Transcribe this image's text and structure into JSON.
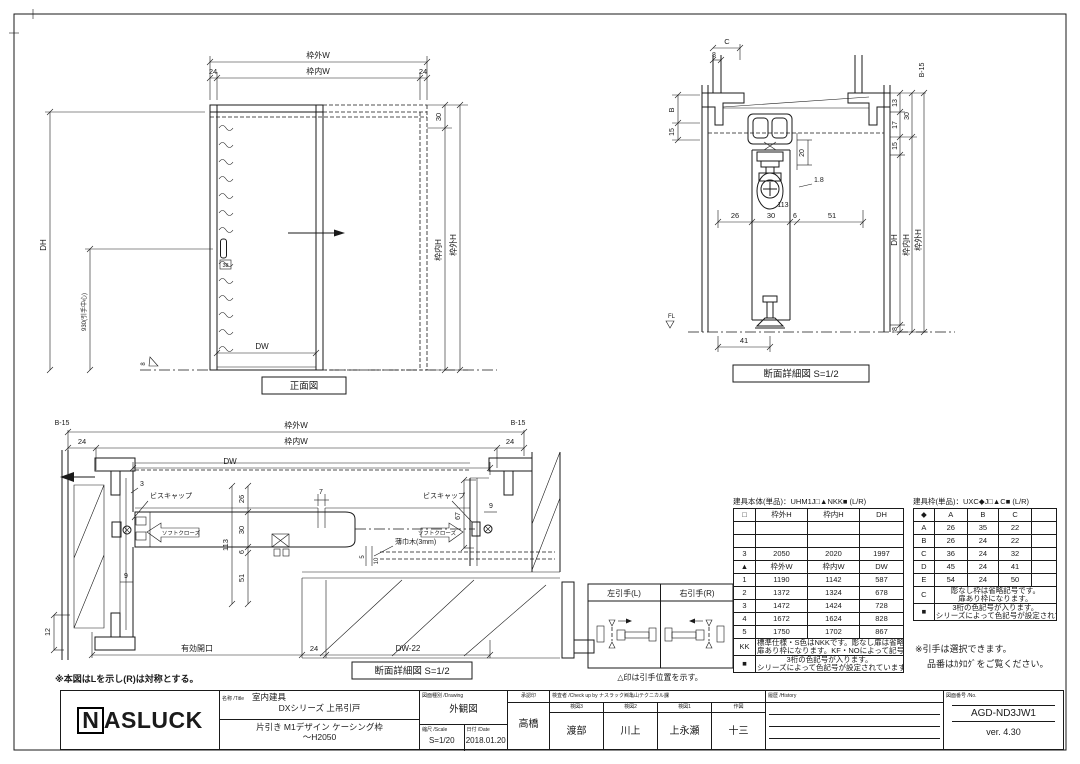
{
  "colors": {
    "paper": "#ffffff",
    "ink": "#1a1a1a"
  },
  "fv": {
    "title": "正面図",
    "wgw": "枠外W",
    "wnw": "枠内W",
    "d24l": "24",
    "d24r": "24",
    "d30": "30",
    "wnh": "枠内H",
    "wgh": "枠外H",
    "dh": "DH",
    "d930": "930(引手中心)",
    "d38": "38",
    "dw": "DW",
    "d8": "8"
  },
  "st": {
    "title": "断面詳細図 S=1/2",
    "c": "C",
    "d8t": "8",
    "b": "B",
    "d15l": "15",
    "d20": "20",
    "d18": "1.8",
    "d113": "113",
    "d26": "26",
    "d30": "30",
    "d6": "6",
    "d51": "51",
    "b15": "B-15",
    "d13": "13",
    "d17": "17",
    "d30r": "30",
    "d15r": "15",
    "dh": "DH",
    "wnh": "枠内H",
    "wgh": "枠外H",
    "d8b": "8",
    "d41": "41",
    "fl": "FL"
  },
  "sp": {
    "title": "断面詳細図 S=1/2",
    "note": "※本図はLを示し(R)は対称とする。",
    "b15l": "B-15",
    "b15r": "B-15",
    "wgw": "枠外W",
    "wnw": "枠内W",
    "d24l": "24",
    "d24r": "24",
    "dw": "DW",
    "d3": "3",
    "d7": "7",
    "d9l": "9",
    "d9r": "9",
    "d12": "12",
    "d67": "67",
    "d5": "5",
    "d10": "10",
    "d26": "26",
    "d30": "30",
    "d6": "6",
    "d51": "51",
    "d113": "113",
    "viscap_l": "ビスキャップ",
    "viscap_r": "ビスキャップ",
    "soft_l": "ソフトクローズ",
    "soft_r": "ソフトクローズ",
    "skirting": "薄巾木(3mm)",
    "opening": "有効開口",
    "d24b": "24",
    "dw22": "DW-22"
  },
  "hb": {
    "left": "左引手(L)",
    "right": "右引手(R)",
    "caption": "△印は引手位置を示す。"
  },
  "tb": {
    "title": "建具本体(単品)：UHM1J□▲NKK■ (L/R)",
    "h": [
      "□",
      "枠外H",
      "枠内H",
      "DH"
    ],
    "r3": [
      "3",
      "2050",
      "2020",
      "1997"
    ],
    "wh": [
      "▲",
      "枠外W",
      "枠内W",
      "DW"
    ],
    "w1": [
      "1",
      "1190",
      "1142",
      "587"
    ],
    "w2": [
      "2",
      "1372",
      "1324",
      "678"
    ],
    "w3": [
      "3",
      "1472",
      "1424",
      "728"
    ],
    "w4": [
      "4",
      "1672",
      "1624",
      "828"
    ],
    "w5": [
      "5",
      "1750",
      "1702",
      "867"
    ],
    "kk_key": "KK",
    "kk_note1": "標準仕様・S色はNKKです。彫なし扉は省略記号です。",
    "kk_note2": "扉あり枠になります。KF・NOによって記号は異なります。",
    "sq_key": "■",
    "sq_note1": "3桁の色記号が入ります。",
    "sq_note2": "シリーズによって色記号が設定されています。"
  },
  "tf": {
    "title": "建具枠(単品)：UXC◆J□▲C■ (L/R)",
    "h": [
      "◆",
      "A",
      "B",
      "C"
    ],
    "rA": [
      "A",
      "26",
      "35",
      "22"
    ],
    "rB": [
      "B",
      "26",
      "24",
      "22"
    ],
    "rC": [
      "C",
      "36",
      "24",
      "32"
    ],
    "rD": [
      "D",
      "45",
      "24",
      "41"
    ],
    "rE": [
      "E",
      "54",
      "24",
      "50"
    ],
    "c_key": "C",
    "c_note1": "彫なし枠は省略記号です。",
    "c_note2": "扉あり枠になります。",
    "sq_key": "■",
    "sq_note1": "3桁の色記号が入ります。",
    "sq_note2": "シリーズによって色記号が設定されています。",
    "remark1": "※引手は選択できます。",
    "remark2": "品番はｶﾀﾛｸﾞをご覧ください。"
  },
  "ttl": {
    "logo_n": "N",
    "logo_rest": "ASLUCK",
    "name_label": "名称 /Title",
    "name1": "室内建具",
    "name2": "DXシリーズ 上吊引戸",
    "name3": "片引き M1デザイン ケーシング枠",
    "name4": "～H2050",
    "drw_label": "図面種別 /Drawing",
    "drw": "外観図",
    "scale_label": "縮尺 /Scale",
    "scale": "S=1/20",
    "date_label": "日付 /Date",
    "date": "2018.01.20",
    "appr_label": "承認印",
    "appr": "高橋",
    "check_label": "検査者 /Check up by ナスラック㈱亀山テクニカル課",
    "c3_label": "検図3",
    "c3": "渡部",
    "c2_label": "検図2",
    "c2": "川上",
    "c1_label": "検図1",
    "c1": "上永瀬",
    "c0_label": "作図",
    "c0": "十三",
    "hist_label": "履歴 /History",
    "no_label": "図面番号 /No.",
    "no": "AGD-ND3JW1",
    "ver": "ver. 4.30"
  }
}
